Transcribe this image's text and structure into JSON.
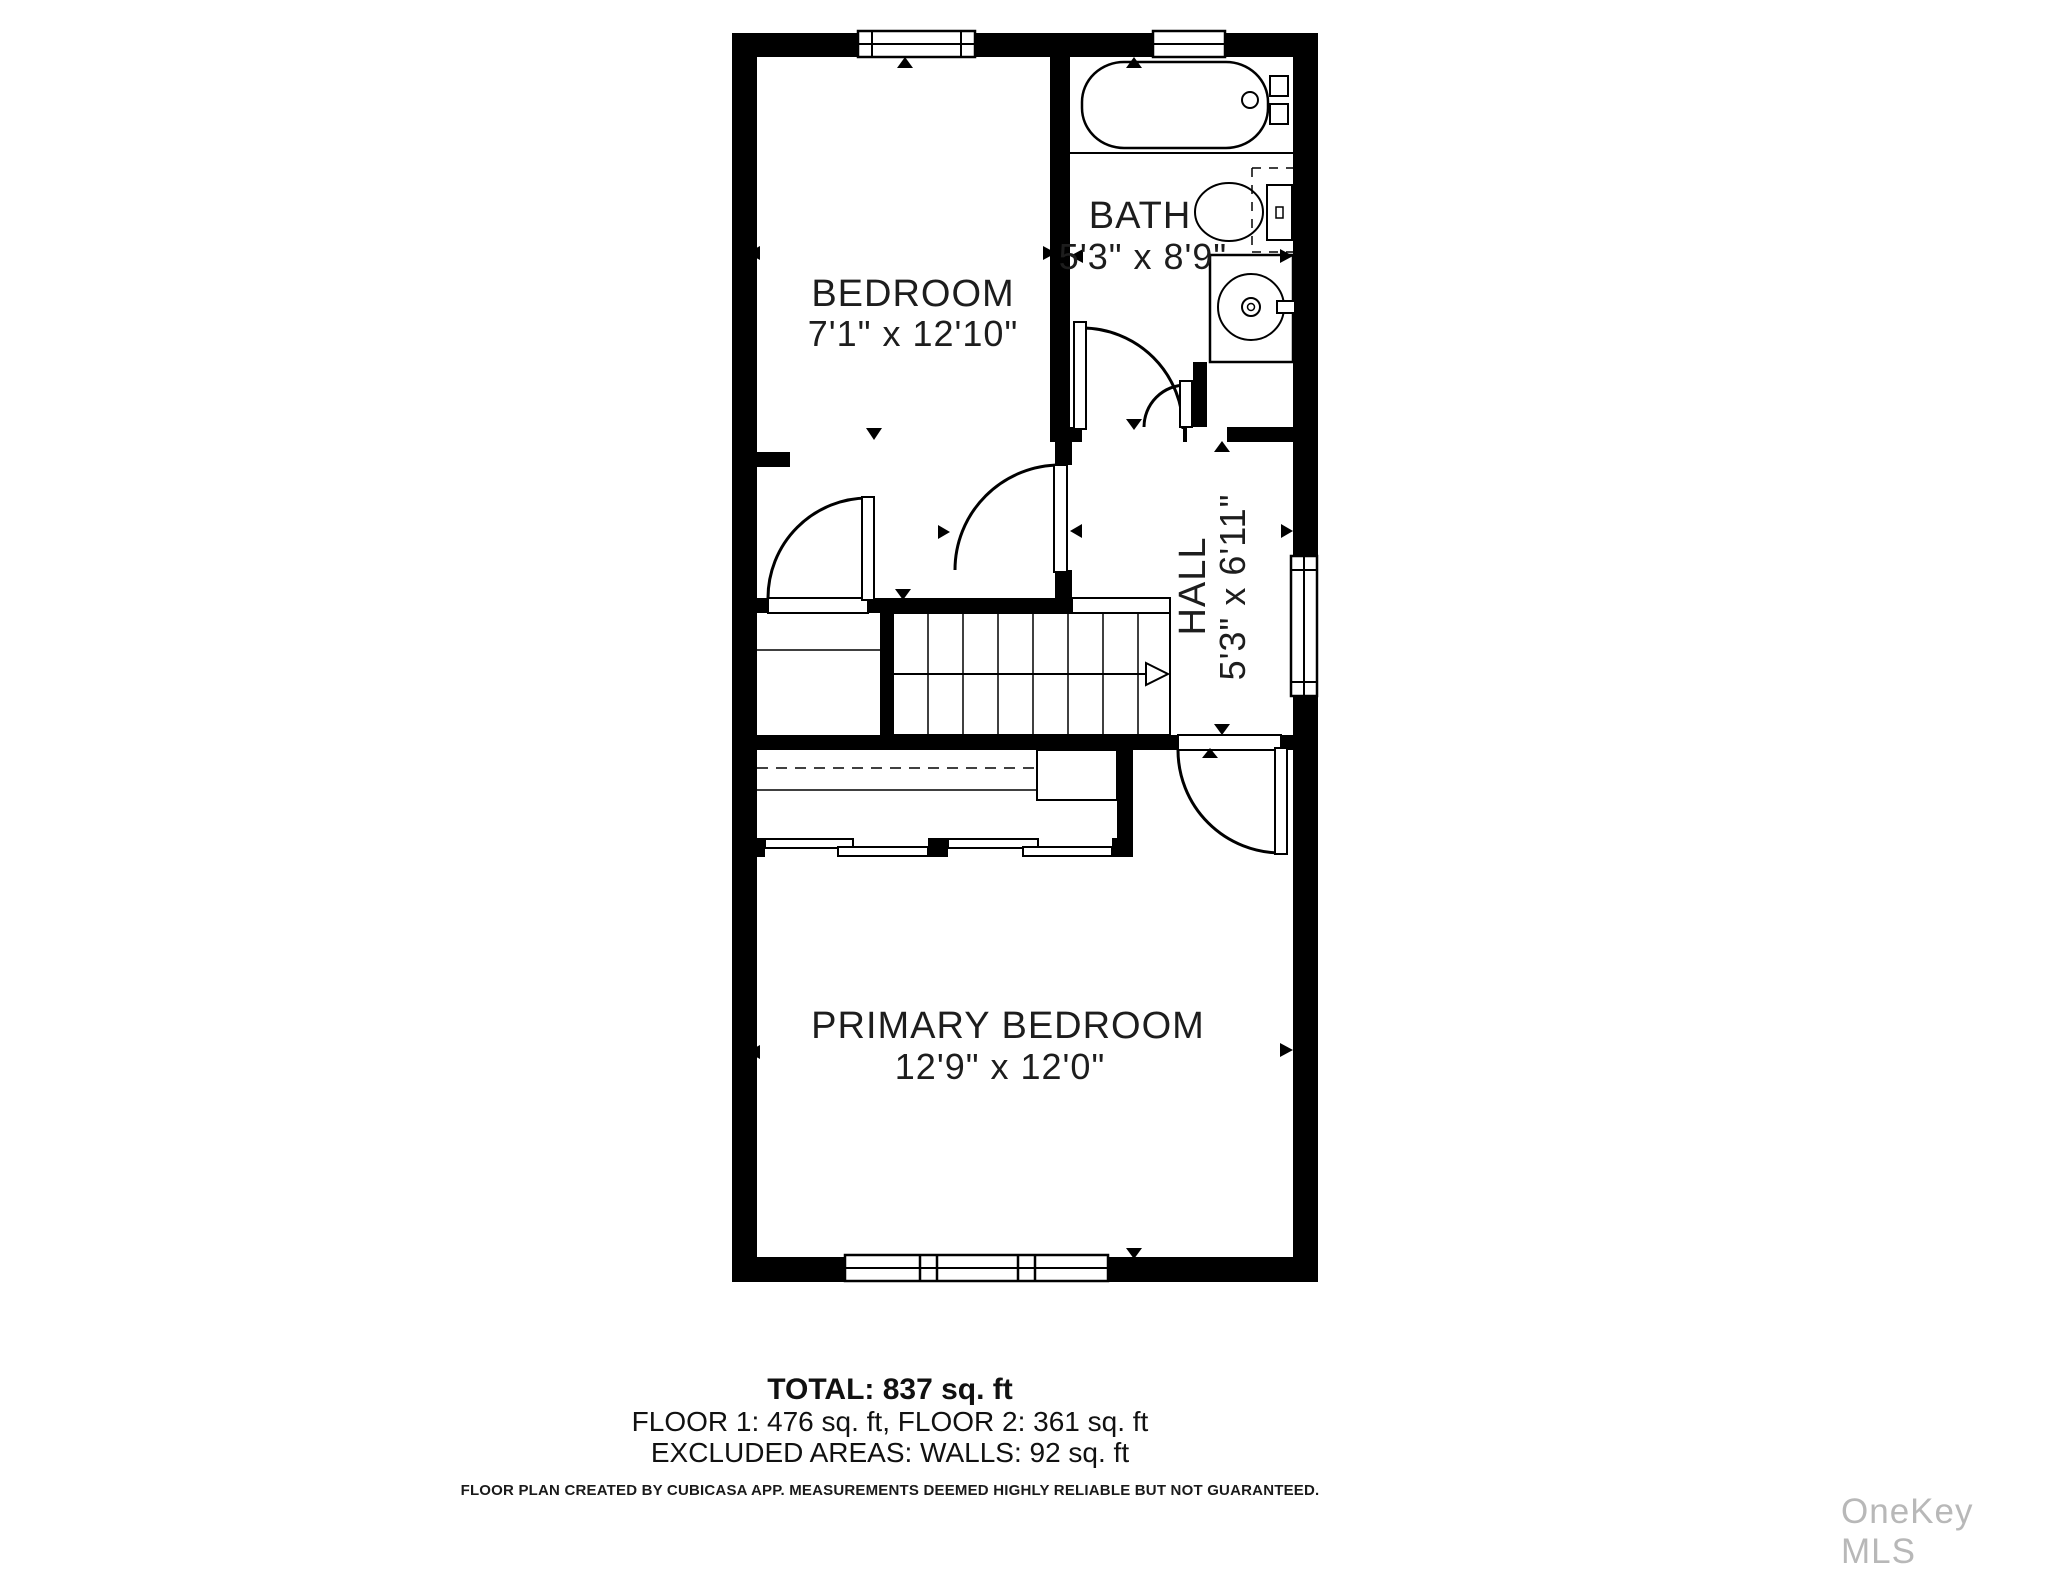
{
  "floor_plan": {
    "rooms": [
      {
        "name": "BEDROOM",
        "dimensions": "7'1\" x 12'10\""
      },
      {
        "name": "BATH",
        "dimensions": "5'3\" x 8'9\""
      },
      {
        "name": "HALL",
        "dimensions": "5'3\" x 6'11\""
      },
      {
        "name": "PRIMARY BEDROOM",
        "dimensions": "12'9\" x 12'0\""
      }
    ],
    "fixtures": [
      "bathtub",
      "toilet",
      "sink-vanity",
      "stairs",
      "sliding-closet-doors",
      "closet-rod"
    ],
    "summary": {
      "total": "TOTAL: 837 sq. ft",
      "floors": "FLOOR 1: 476 sq. ft, FLOOR 2: 361 sq. ft",
      "excluded": "EXCLUDED AREAS: WALLS: 92 sq. ft"
    },
    "disclaimer": "FLOOR PLAN CREATED BY CUBICASA APP. MEASUREMENTS DEEMED HIGHLY RELIABLE BUT NOT GUARANTEED.",
    "watermark": "OneKey MLS",
    "colors": {
      "walls": "#000000",
      "background": "#ffffff",
      "text": "#1d1d1d",
      "watermark": "#b8b8b8"
    }
  }
}
